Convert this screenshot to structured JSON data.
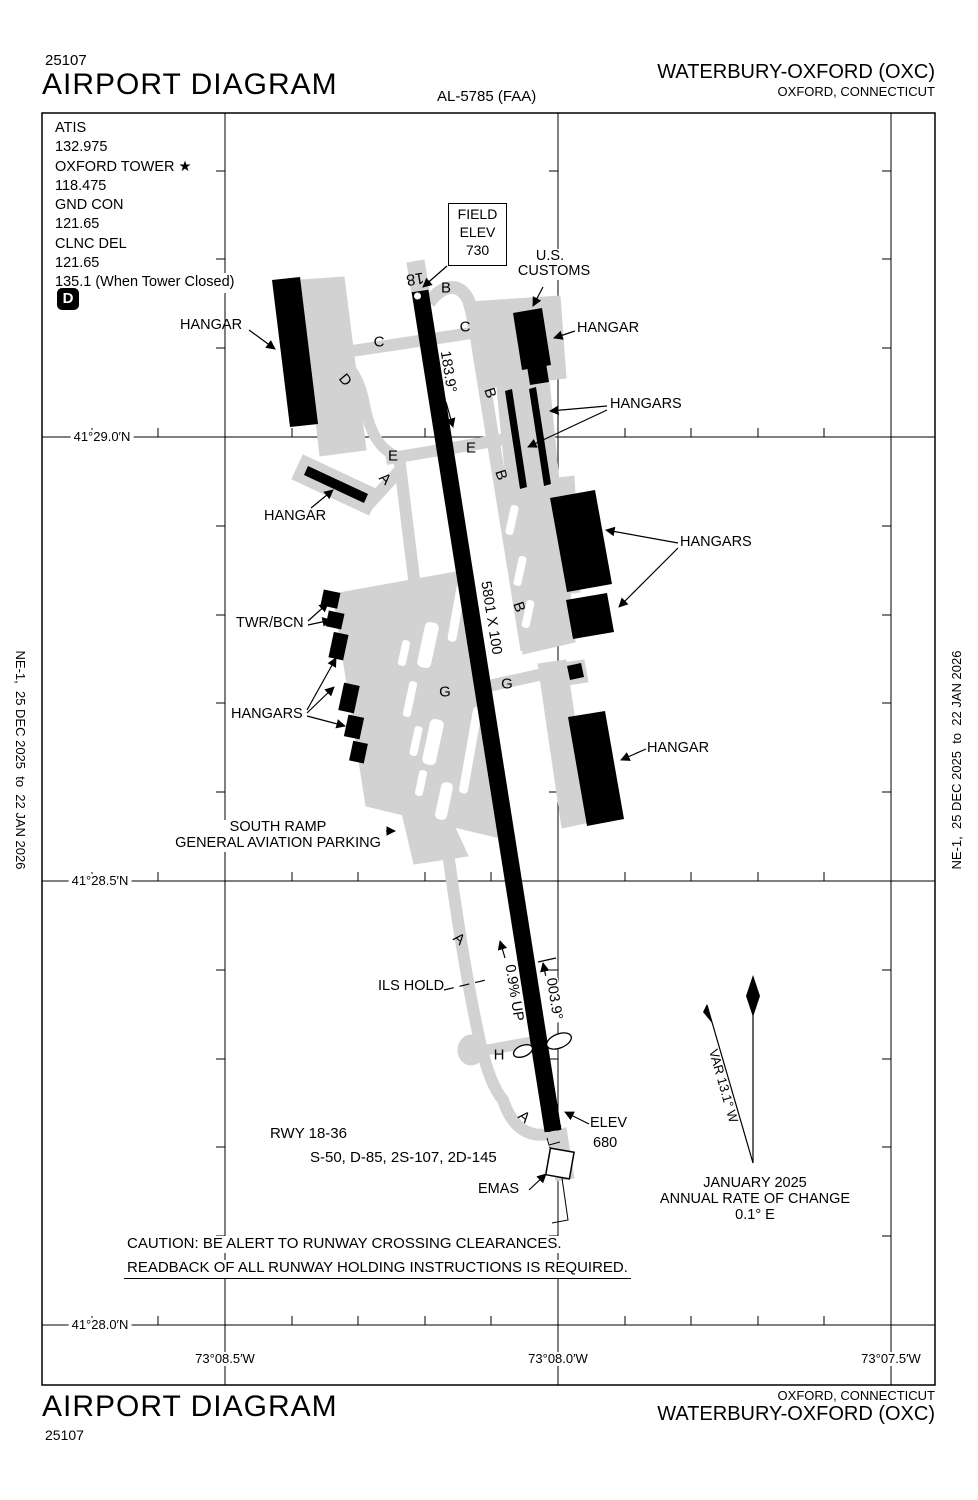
{
  "header": {
    "chart_number": "25107",
    "title": "AIRPORT DIAGRAM",
    "al_number": "AL-5785 (FAA)",
    "airport_name": "WATERBURY-OXFORD (OXC)",
    "airport_city": "OXFORD, CONNECTICUT"
  },
  "footer": {
    "title": "AIRPORT DIAGRAM",
    "chart_number": "25107",
    "airport_name": "WATERBURY-OXFORD (OXC)",
    "airport_city": "OXFORD, CONNECTICUT"
  },
  "margin_note": "NE-1,  25 DEC 2025  to  22 JAN 2026",
  "comms": {
    "lines": [
      "ATIS",
      "132.975",
      "OXFORD TOWER ★",
      "118.475",
      "GND CON",
      "121.65",
      "CLNC DEL",
      "121.65",
      "135.1 (When Tower Closed)"
    ],
    "d_symbol": "D"
  },
  "field_elev": {
    "label1": "FIELD",
    "label2": "ELEV",
    "value": "730"
  },
  "runway": {
    "num18": "18",
    "num36": "36",
    "hdg18": "183.9°",
    "hdg36": "003.9°",
    "size": "5801 X 100",
    "slope": "0.9% UP",
    "elev_label": "ELEV",
    "elev_value": "680",
    "info1": "RWY 18-36",
    "info2": "S-50, D-85, 2S-107, 2D-145",
    "emas": "EMAS"
  },
  "labels": {
    "us_customs1": "U.S.",
    "us_customs2": "CUSTOMS",
    "twr_bcn": "TWR/BCN",
    "south_ramp1": "SOUTH RAMP",
    "south_ramp2": "GENERAL AVIATION PARKING",
    "ils_hold": "ILS HOLD"
  },
  "hangar_labels": {
    "top_left": "HANGAR",
    "customs_east": "HANGAR",
    "upper_right": "HANGARS",
    "right": "HANGARS",
    "lower_right": "HANGAR",
    "diagonal": "HANGAR",
    "west": "HANGARS"
  },
  "taxiways": {
    "b_top": "B",
    "c_east": "C",
    "c_west": "C",
    "d": "D",
    "b_mid": "B",
    "b_mid2": "B",
    "e_west": "E",
    "e_east": "E",
    "a_upper": "A",
    "b_lower": "B",
    "g_west": "G",
    "g_east": "G",
    "a_mid": "A",
    "h": "H",
    "a_bottom": "A"
  },
  "compass": {
    "var": "VAR 13.1° W",
    "date": "JANUARY 2025",
    "rate_label": "ANNUAL RATE OF CHANGE",
    "rate_value": "0.1° E"
  },
  "caution": {
    "line1": "CAUTION: BE ALERT TO RUNWAY CROSSING CLEARANCES.",
    "line2": "READBACK OF ALL RUNWAY HOLDING INSTRUCTIONS IS REQUIRED."
  },
  "graticule": {
    "lat": [
      "41°29.0′N",
      "41°28.5′N",
      "41°28.0′N"
    ],
    "lon": [
      "73°08.5′W",
      "73°08.0′W",
      "73°07.5′W"
    ]
  },
  "colors": {
    "pavement_gray": "#d2d2d2",
    "ink": "#000000"
  }
}
